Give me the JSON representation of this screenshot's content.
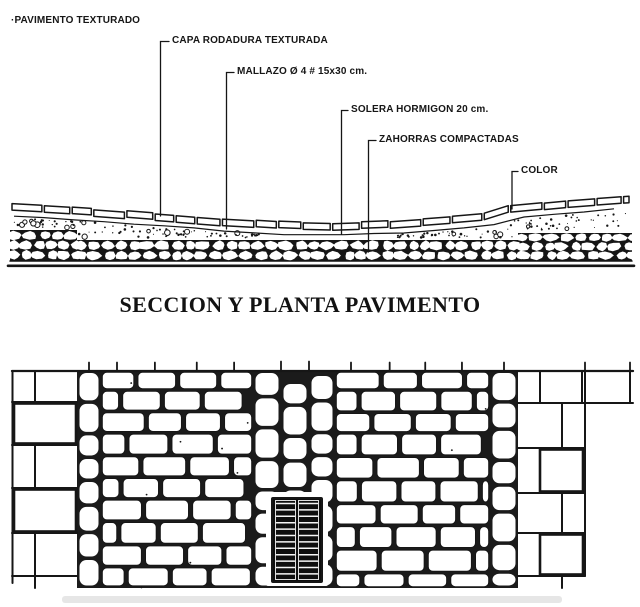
{
  "page": {
    "background": "#ffffff",
    "ink": "#161616",
    "scan_band": "#d6d6d6"
  },
  "title": "SECCION Y PLANTA PAVIMENTO",
  "section_view": {
    "annotations": {
      "pavimento_texturado": "·PAVIMENTO TEXTURADO",
      "capa_rodadura": "CAPA RODADURA TEXTURADA",
      "mallazo": "MALLAZO Ø 4 # 15x30 cm.",
      "solera": "SOLERA HORMIGON 20 cm.",
      "zahorras": "ZAHORRAS COMPACTADAS",
      "color": "COLOR"
    }
  }
}
